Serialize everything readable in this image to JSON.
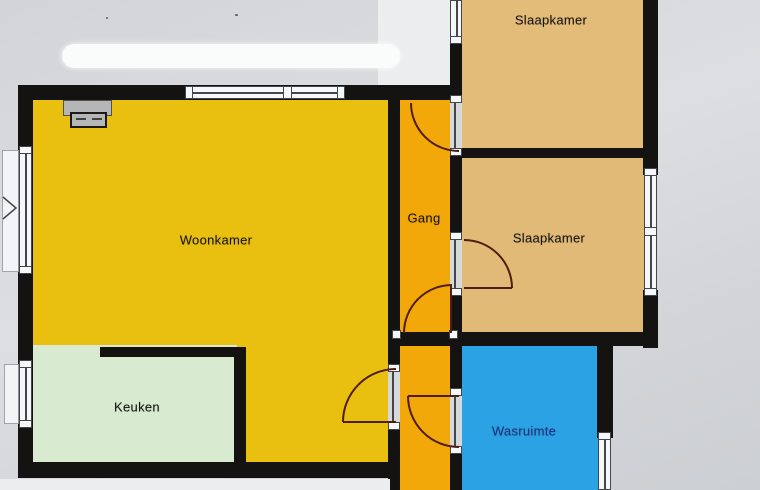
{
  "rooms": {
    "woonkamer": {
      "label": "Woonkamer",
      "color": "#e9c010",
      "text_color": "#181712"
    },
    "gang": {
      "label": "Gang",
      "color": "#f2a808",
      "text_color": "#1d1408"
    },
    "slaapkamer1": {
      "label": "Slaapkamer",
      "color": "#e3bc7a",
      "text_color": "#181410"
    },
    "slaapkamer2": {
      "label": "Slaapkamer",
      "color": "#e1ba77",
      "text_color": "#181410"
    },
    "keuken": {
      "label": "Keuken",
      "color": "#d8ebd0",
      "text_color": "#11170f"
    },
    "wasruimte": {
      "label": "Wasruimte",
      "color": "#2aa2e4",
      "text_color": "#1d2f80"
    }
  },
  "palette": {
    "background": "#d2d4d8",
    "wall": "#151311",
    "window_fill": "#f6f7f8",
    "window_line": "#43464b",
    "door_gap": "#d7d8da",
    "door_arc": "#4f1d0f",
    "chimney": "#b5b6b8",
    "highlight_bar": "#fafbfb",
    "highlight_panel": "#ecedef"
  }
}
